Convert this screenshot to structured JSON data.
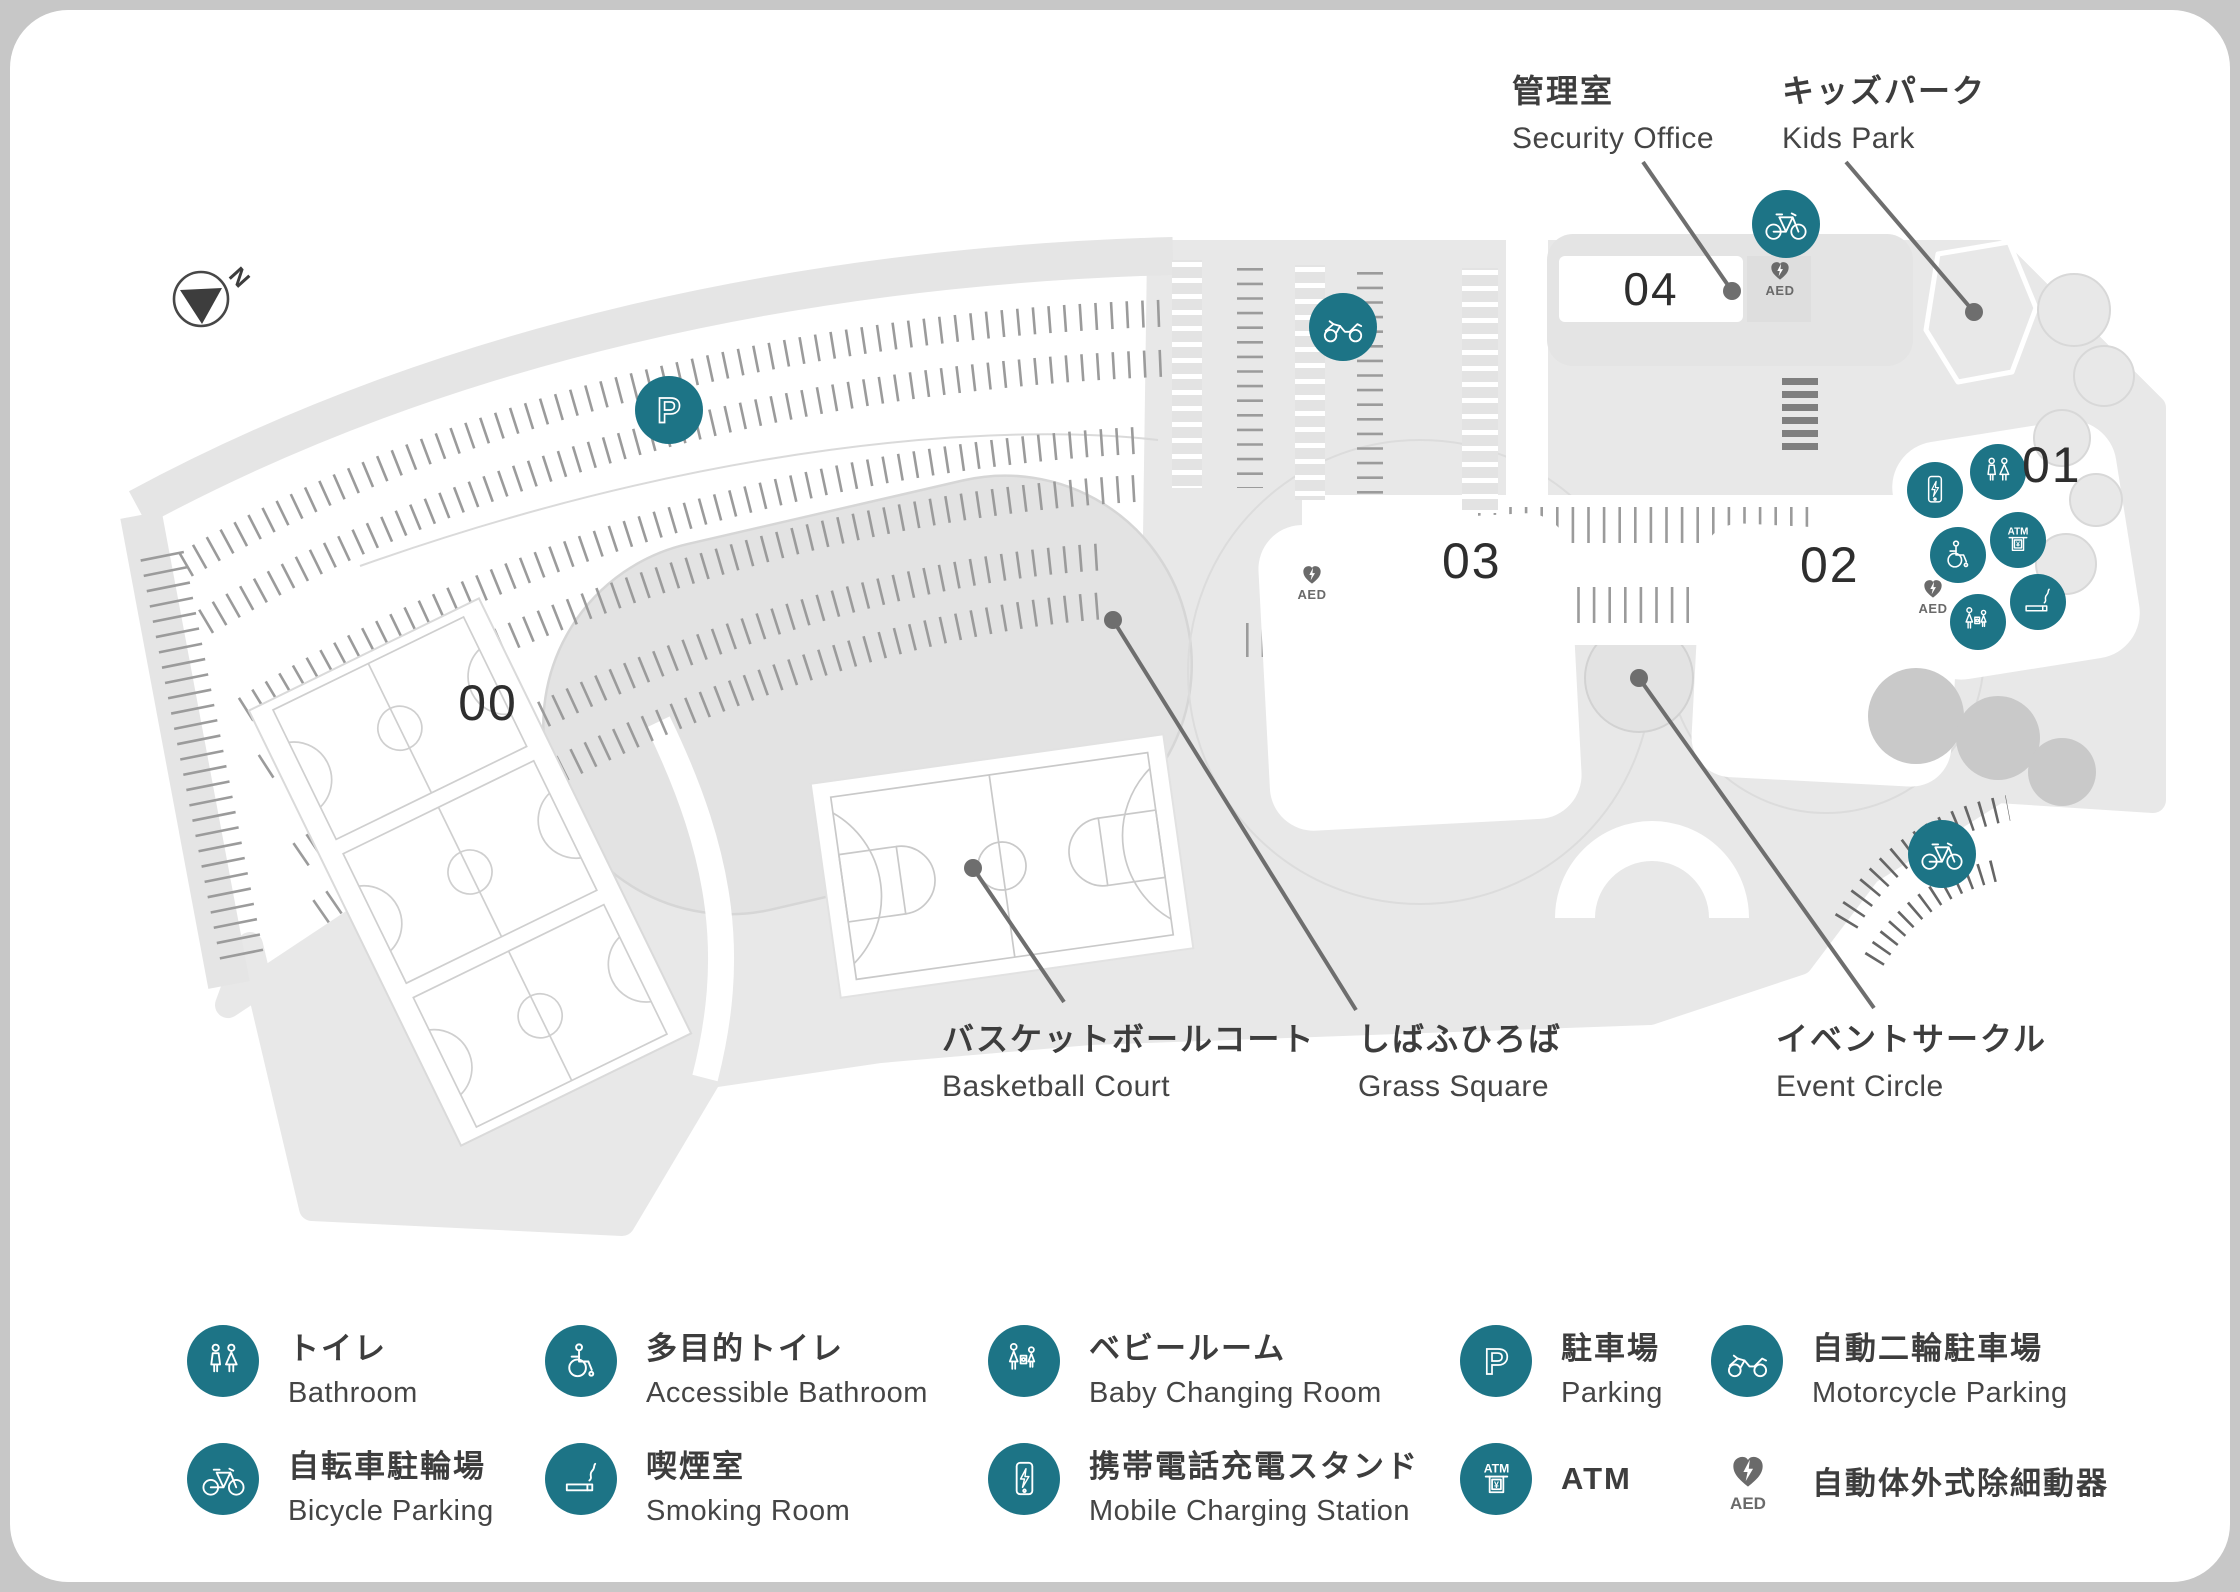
{
  "colors": {
    "accent_teal": "#1d7486",
    "aed_gray": "#6a6a6a",
    "ground_gray": "#e8e8e8"
  },
  "compass": {
    "label": "N"
  },
  "buildings": {
    "b00": "00",
    "b01": "01",
    "b02": "02",
    "b03": "03",
    "b04": "04"
  },
  "callouts": {
    "security_office": {
      "jp": "管理室",
      "en": "Security Office"
    },
    "kids_park": {
      "jp": "キッズパーク",
      "en": "Kids Park"
    },
    "basketball_court": {
      "jp": "バスケットボールコート",
      "en": "Basketball Court"
    },
    "grass_square": {
      "jp": "しばふひろば",
      "en": "Grass Square"
    },
    "event_circle": {
      "jp": "イベントサークル",
      "en": "Event Circle"
    }
  },
  "markers": {
    "aed_label": "AED",
    "parking_letter": "P",
    "atm_label": "ATM",
    "yen": "¥"
  },
  "legend": {
    "items": [
      {
        "id": "bathroom",
        "jp": "トイレ",
        "en": "Bathroom"
      },
      {
        "id": "accessible-bathroom",
        "jp": "多目的トイレ",
        "en": "Accessible Bathroom"
      },
      {
        "id": "baby-changing-room",
        "jp": "ベビールーム",
        "en": "Baby Changing Room"
      },
      {
        "id": "parking",
        "jp": "駐車場",
        "en": "Parking"
      },
      {
        "id": "motorcycle-parking",
        "jp": "自動二輪駐車場",
        "en": "Motorcycle Parking"
      },
      {
        "id": "bicycle-parking",
        "jp": "自転車駐輪場",
        "en": "Bicycle Parking"
      },
      {
        "id": "smoking-room",
        "jp": "喫煙室",
        "en": "Smoking Room"
      },
      {
        "id": "mobile-charging-station",
        "jp": "携帯電話充電スタンド",
        "en": "Mobile Charging Station"
      },
      {
        "id": "atm",
        "jp": "ATM",
        "en": ""
      },
      {
        "id": "aed",
        "jp": "自動体外式除細動器",
        "en": ""
      }
    ]
  }
}
